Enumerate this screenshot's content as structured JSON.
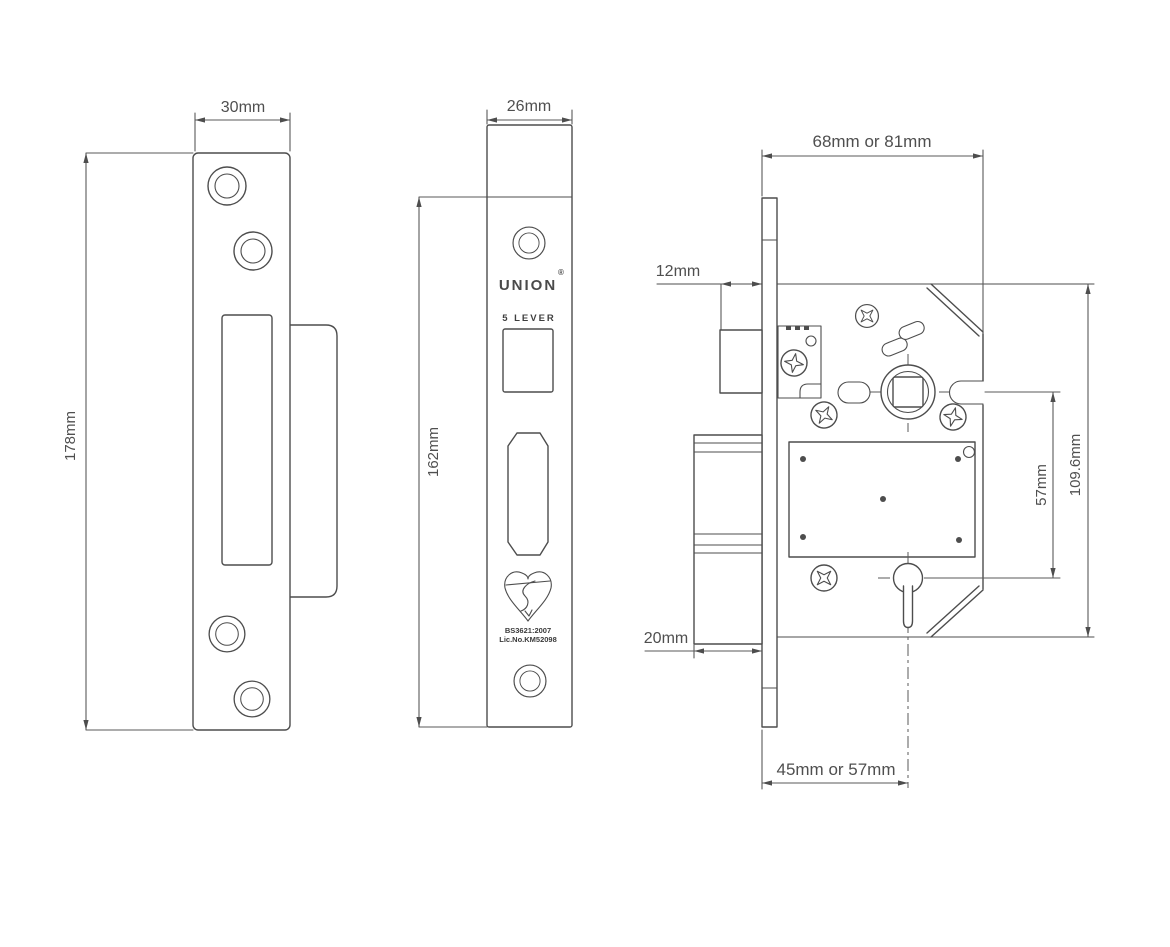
{
  "drawing_title": "UNION 5 lever mortice sashlock technical drawing",
  "colors": {
    "line": "#4d4d4d",
    "text": "#4f4f4f",
    "background": "#ffffff"
  },
  "strike_plate": {
    "width_dim": "30mm",
    "height_dim": "178mm"
  },
  "forend": {
    "width_dim": "26mm",
    "height_dim": "162mm",
    "brand": "UNION",
    "registered": "®",
    "lever_text": "5 LEVER",
    "standard_text": "BS3621:2007",
    "licence_text": "Lic.No.KM52098"
  },
  "lock_case": {
    "depth_dim": "68mm or 81mm",
    "latch_projection_dim": "12mm",
    "bolt_projection_dim": "20mm",
    "backset_dim": "45mm or 57mm",
    "centres_dim": "57mm",
    "case_height_dim": "109.6mm"
  }
}
